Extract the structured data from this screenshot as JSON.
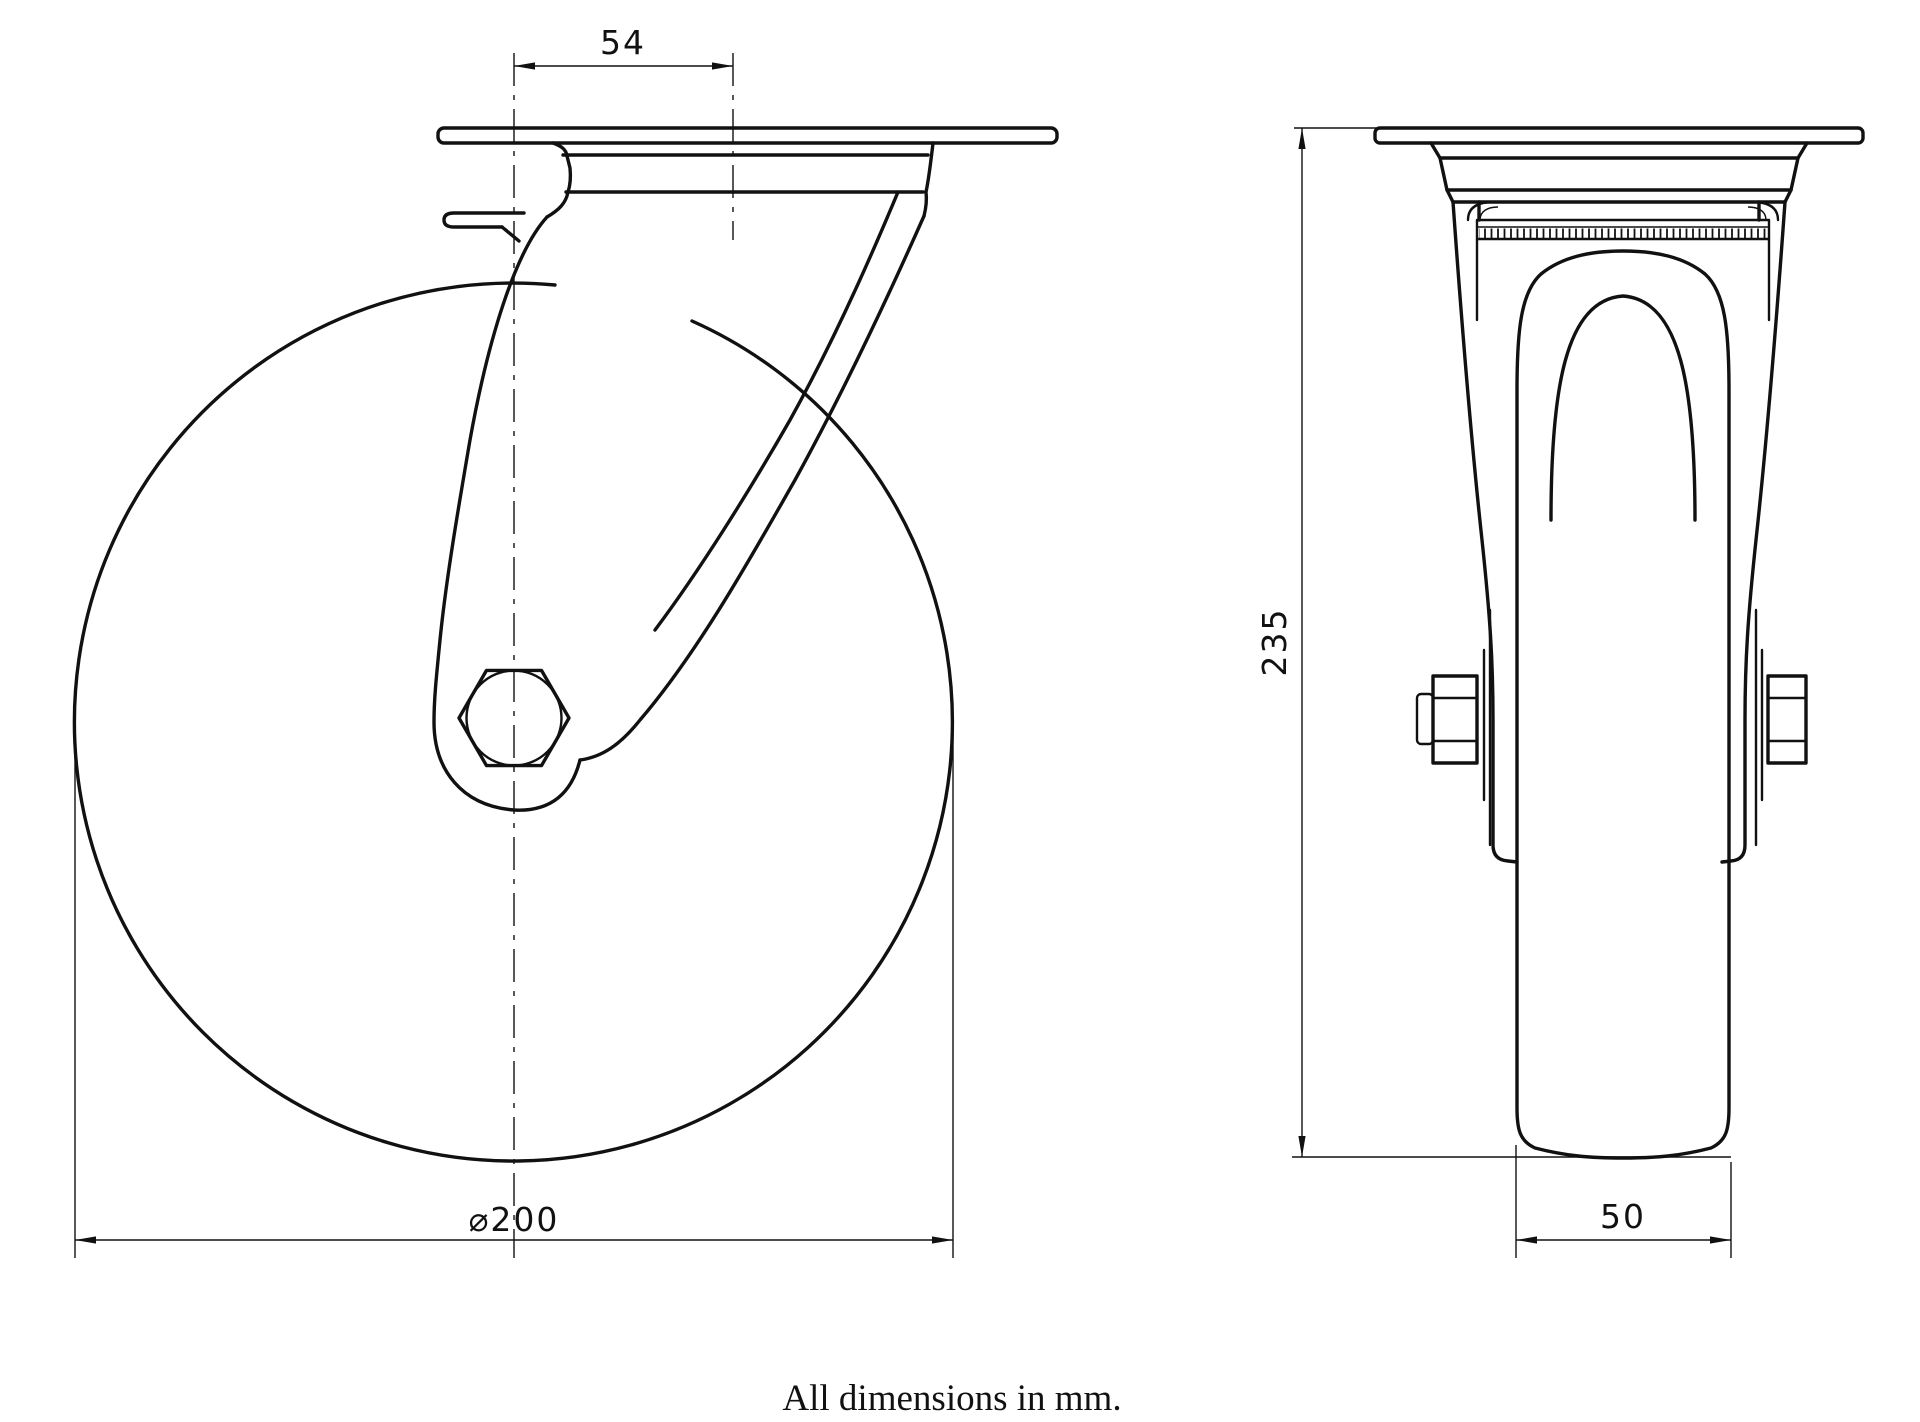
{
  "drawing": {
    "note": "All dimensions in mm.",
    "dimensions": {
      "swivel_offset": {
        "label": "54"
      },
      "overall_height": {
        "label": "235"
      },
      "wheel_diameter": {
        "label": "⌀200"
      },
      "wheel_width": {
        "label": "50"
      }
    },
    "colors": {
      "line": "#111111",
      "background": "#ffffff"
    }
  }
}
